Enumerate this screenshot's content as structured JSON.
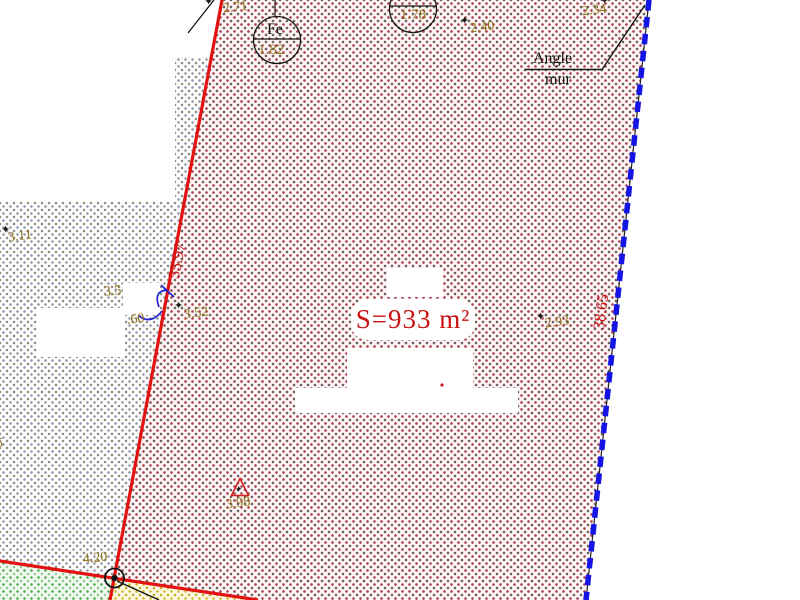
{
  "canvas": {
    "width": 800,
    "height": 600
  },
  "colors": {
    "boundary_red": "#e31212",
    "boundary_blue": "#1414e6",
    "annotation_olive": "#8d721b",
    "area_text_red": "#cc1111",
    "parcel_dot": "#a8434f",
    "neighbor_dot": "#8c96a8",
    "green_dot": "#46a846",
    "yellow_dot": "#cdbb22"
  },
  "parcel": {
    "area_label": "S=933 m²"
  },
  "boundaries": {
    "left_length": "35.97",
    "right_length": "38.65"
  },
  "wall_note": {
    "line1": "Angle",
    "line2": "mur"
  },
  "iron_markers": [
    {
      "label": "Fe",
      "value": "1.82"
    },
    {
      "label": "Fe",
      "value": "1.78"
    }
  ],
  "spot_elevations": [
    {
      "value": "2.71"
    },
    {
      "value": "2.40"
    },
    {
      "value": "2.34"
    },
    {
      "value": "3.11"
    },
    {
      "value": "3.5"
    },
    {
      "value": ".60"
    },
    {
      "value": "3.52"
    },
    {
      "value": "2.93"
    },
    {
      "value": "3.98"
    },
    {
      "value": "4.20"
    },
    {
      "value": "5"
    }
  ],
  "icons": {
    "survey_point": "✦"
  }
}
